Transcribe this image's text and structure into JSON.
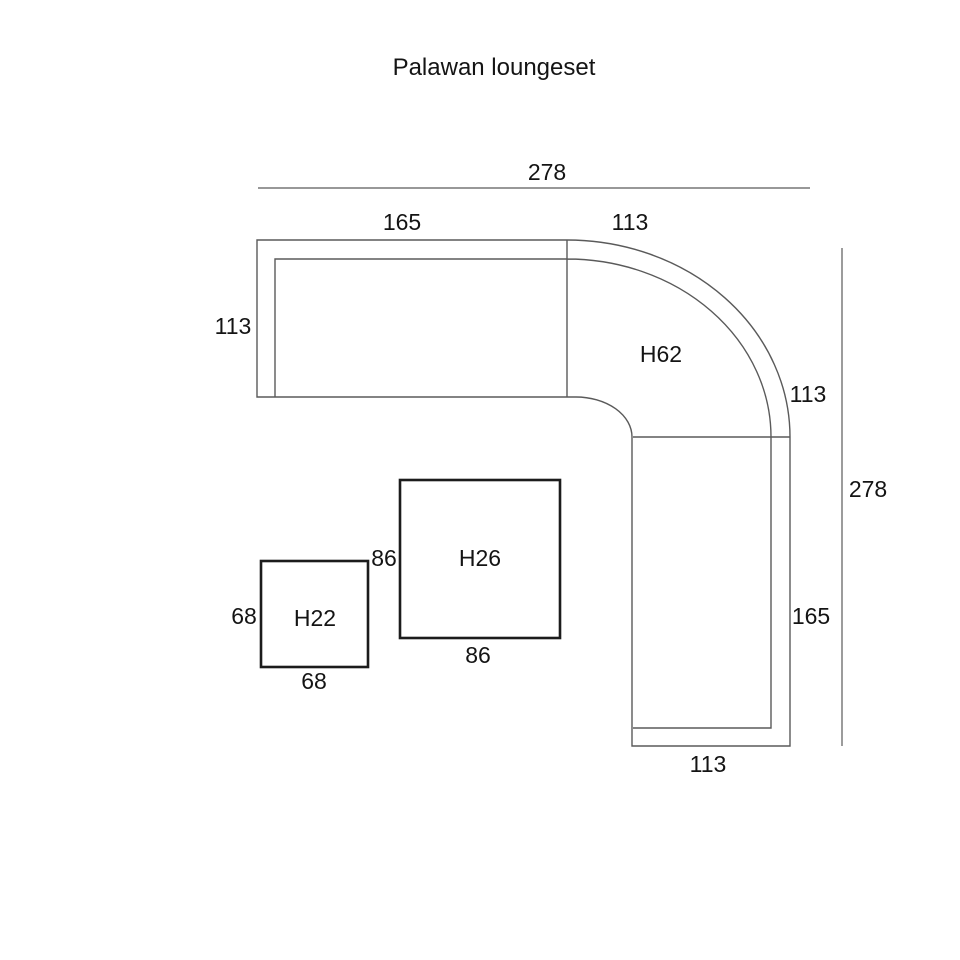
{
  "title": "Palawan loungeset",
  "colors": {
    "line": "#5a5a5a",
    "table_line": "#1c1c1c",
    "text": "#141414",
    "background": "#ffffff"
  },
  "sofa": {
    "corner_label": "H62",
    "dims": {
      "total_width": "278",
      "left_length": "165",
      "corner_top": "113",
      "left_depth": "113",
      "corner_right": "113",
      "total_depth": "278",
      "right_length": "165",
      "bottom_width": "113"
    }
  },
  "tables": {
    "large": {
      "label": "H26",
      "width": "86",
      "depth": "86"
    },
    "small": {
      "label": "H22",
      "width": "68",
      "depth": "68"
    }
  }
}
